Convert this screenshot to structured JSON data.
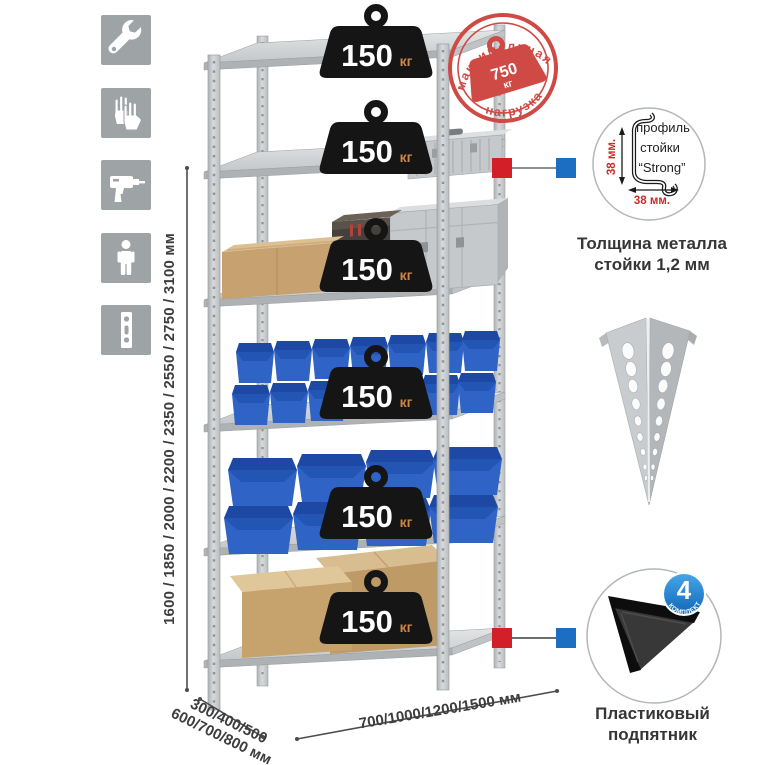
{
  "page": {
    "background": "#ffffff"
  },
  "toolbar_icons": {
    "background": "#9ea3a6",
    "items": [
      {
        "name": "wrench"
      },
      {
        "name": "gloves"
      },
      {
        "name": "drill"
      },
      {
        "name": "person"
      },
      {
        "name": "perforated-post"
      }
    ]
  },
  "height_dimension": {
    "label": "1600 / 1850 / 2000 / 2200 / 2350 / 2550 / 2750 / 3100 мм"
  },
  "rack": {
    "shelf_count": 6,
    "shelf_load_value": "150",
    "shelf_load_unit": "кг",
    "badge_color": "#151515",
    "unit_color": "#d08642"
  },
  "max_load_stamp": {
    "arc_top": "максимальная",
    "arc_bottom": "нагрузка",
    "value": "750",
    "unit": "кг",
    "color": "#cf4a45"
  },
  "profile_detail": {
    "label_line1": "профиль",
    "label_line2": "стойки",
    "label_line3": "“Strong”",
    "dim_vertical": "38 мм.",
    "dim_horizontal": "38 мм.",
    "dim_color": "#cc2b28",
    "caption_line1": "Толщина металла",
    "caption_line2": "стойки 1,2 мм"
  },
  "foot_detail": {
    "badge_value": "4",
    "badge_caption": "в комплекте",
    "badge_color": "#1d86d8",
    "caption_line1": "Пластиковый",
    "caption_line2": "подпятник"
  },
  "depth_dimension": {
    "line1": "300/400/500",
    "line2": "600/700/800 мм"
  },
  "width_dimension": {
    "label": "700/1000/1200/1500 мм"
  }
}
